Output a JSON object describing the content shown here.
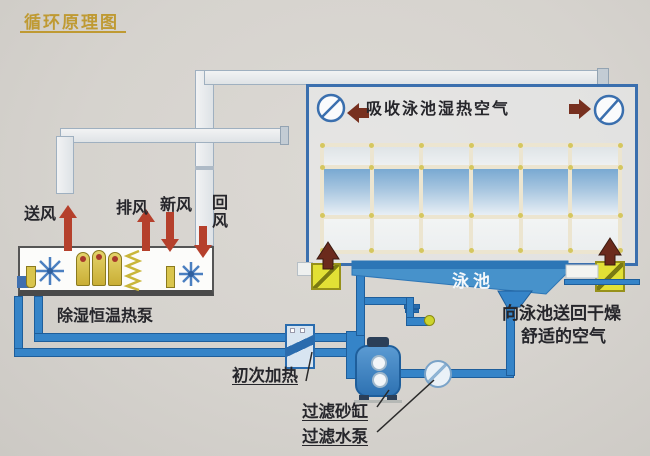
{
  "title": {
    "text": "循环原理图"
  },
  "hall": {
    "absorb_label": "吸收泳池湿热空气",
    "pool_label": "泳池",
    "return_air": {
      "line1": "向泳池送回干燥",
      "line2": "舒适的空气"
    },
    "window_grid": {
      "cols": 6,
      "rows": 3
    }
  },
  "air_flows": {
    "supply": "送风",
    "exhaust": "排风",
    "fresh": "新风",
    "return": "回风"
  },
  "machine": {
    "label": "除湿恒温热泵"
  },
  "water_system": {
    "initial_heating": "初次加热",
    "sand_filter": "过滤砂缸",
    "filter_pump": "过滤水泵"
  },
  "icons": {
    "hall_fan": "circle-with-slash",
    "airflow_arrow": "solid-triangle-arrow",
    "floor_vent": "yellow-damper-box",
    "machine_fan": "snowflake-fan",
    "compressor": "dome-cylinder",
    "heating_coil": "zigzag-coil"
  },
  "colors": {
    "background": "#d6d3ce",
    "title_gold": "#bf9a33",
    "pipe_blue": "#3584c8",
    "pool_blue": "#4792cb",
    "hall_border_blue": "#3a6fae",
    "airflow_red": "#b5402c",
    "vent_arrow_maroon": "#6b2a1c",
    "vent_yellow": "#e2e135",
    "machine_component_yellow": "#d9c54d",
    "label_text": "#26262b"
  }
}
